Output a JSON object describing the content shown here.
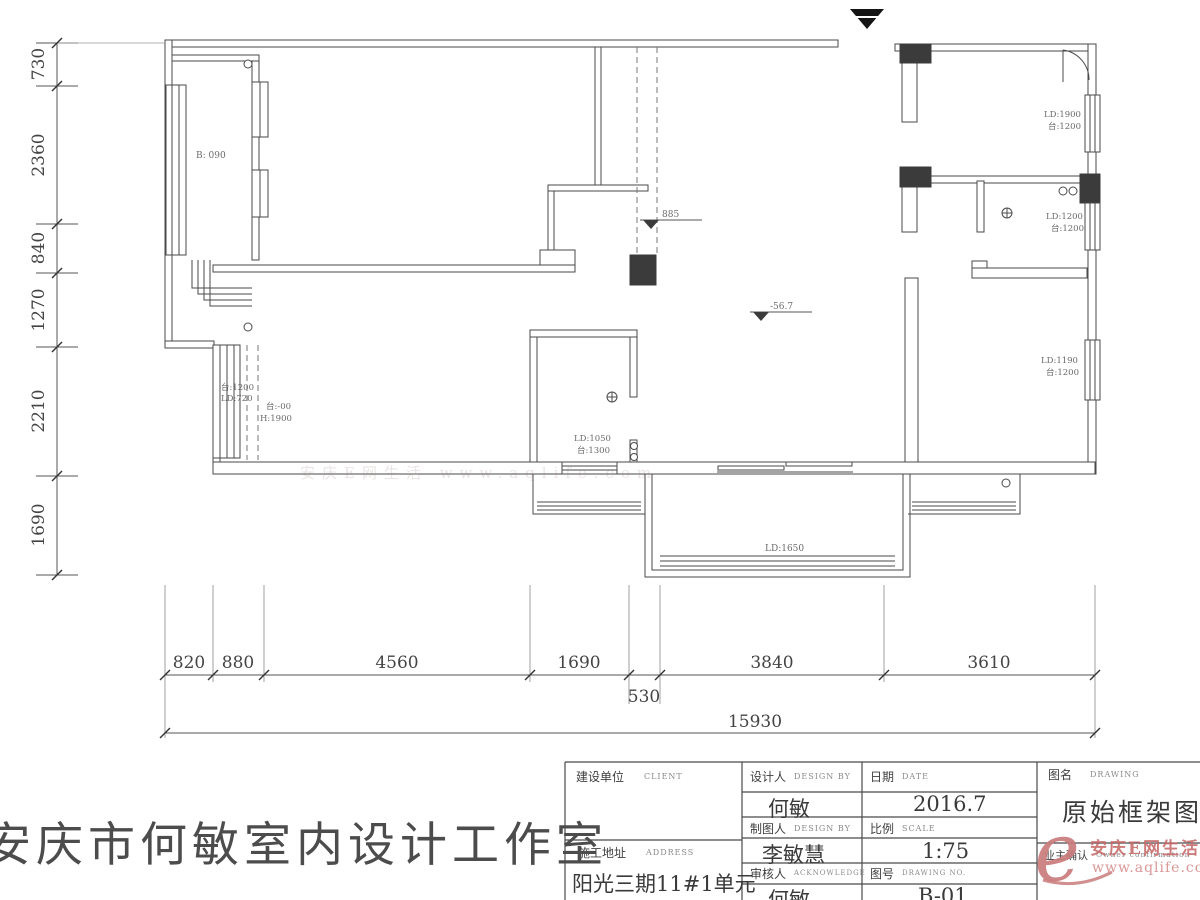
{
  "plan": {
    "drawing_title": "原始框架图",
    "studio_name": "安庆市何敏室内设计工作室"
  },
  "dimensions": {
    "left": [
      "730",
      "2360",
      "840",
      "1270",
      "2210",
      "1690"
    ],
    "bottom": [
      "820",
      "880",
      "4560",
      "1690",
      "3840",
      "3610"
    ],
    "bottom_mid": "530",
    "total": "15930"
  },
  "plan_annotations": {
    "bay": "B: 090",
    "left_window_line1": "台:1200",
    "left_window_line2": "LD:720",
    "left_door_line1": "台:-00",
    "left_door_line2": "H:1900",
    "level_1": "885",
    "level_2": "-56.7",
    "bath_line1": "LD:1050",
    "bath_line2": "台:1300",
    "right_win1_line1": "LD:1900",
    "right_win1_line2": "台:1200",
    "right_win2_line1": "LD:1200",
    "right_win2_line2": "台:1200",
    "right_win3_line1": "LD:1190",
    "right_win3_line2": "台:1200",
    "balcony_door": "LD:1650"
  },
  "title_block": {
    "client_label": "建设单位",
    "client_sub": "CLIENT",
    "designer_label": "设计人",
    "designer_sub": "DESIGN BY",
    "designer_value": "何敏",
    "drafter_label": "制图人",
    "drafter_sub": "DESIGN BY",
    "drafter_value": "李敏慧",
    "auditor_label": "审核人",
    "auditor_sub": "ACKNOWLEDGE",
    "auditor_value": "何敏",
    "address_label": "施工地址",
    "address_sub": "ADDRESS",
    "address_value": "阳光三期11#1单元",
    "date_label": "日期",
    "date_sub": "DATE",
    "date_value": "2016.7",
    "scale_label": "比例",
    "scale_sub": "SCALE",
    "scale_value": "1:75",
    "no_label": "图号",
    "no_sub": "DRAWING NO.",
    "no_value": "B-01",
    "name_label": "图名",
    "name_sub": "DRAWING",
    "name_value": "原始框架图",
    "owner_label": "业主确认",
    "owner_sub": "Owner confirmation"
  },
  "watermark": {
    "logo_letter": "e",
    "brand": "安庆E网生活",
    "url": "www.aqlife.com",
    "faint_line": "安庆E网生活  www.aqlife.com",
    "accent_color": "#c97b7b"
  }
}
